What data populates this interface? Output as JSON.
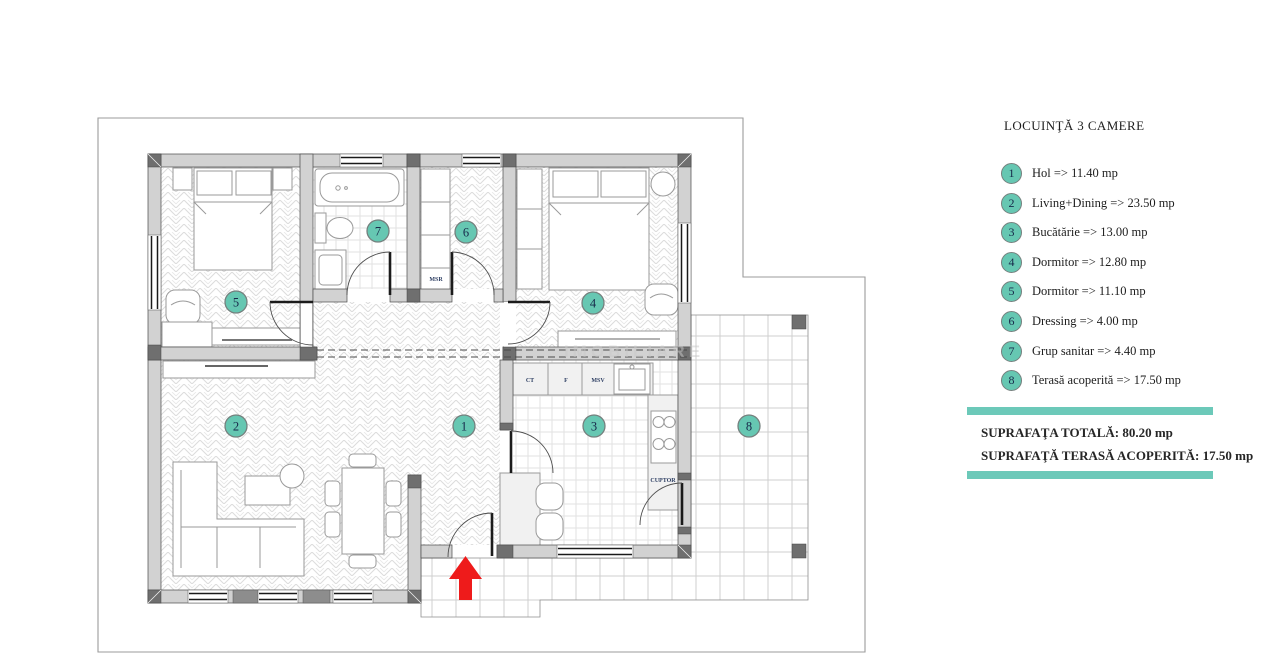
{
  "legend": {
    "title": "LOCUINŢĂ 3 CAMERE",
    "items": [
      {
        "num": "1",
        "label": "Hol => 11.40 mp"
      },
      {
        "num": "2",
        "label": "Living+Dining => 23.50 mp"
      },
      {
        "num": "3",
        "label": "Bucătărie => 13.00 mp"
      },
      {
        "num": "4",
        "label": "Dormitor => 12.80 mp"
      },
      {
        "num": "5",
        "label": "Dormitor => 11.10 mp"
      },
      {
        "num": "6",
        "label": "Dressing => 4.00 mp"
      },
      {
        "num": "7",
        "label": "Grup sanitar => 4.40 mp"
      },
      {
        "num": "8",
        "label": "Terasă acoperită => 17.50 mp"
      }
    ],
    "totals": {
      "line1": "SUPRAFAŢA TOTALĂ: 80.20 mp",
      "line2": "SUPRAFAŢĂ TERASĂ ACOPERITĂ: 17.50 mp"
    }
  },
  "plan": {
    "room_numbers": [
      "1",
      "2",
      "3",
      "4",
      "5",
      "6",
      "7",
      "8"
    ],
    "labels": {
      "msr": "MSR",
      "ct": "CT",
      "f": "F",
      "msv": "MSV",
      "cuptor": "CUPTOR"
    },
    "watermark": "IMOBILIARE"
  },
  "colors": {
    "teal_badge": "#66C7B2",
    "teal_bar": "#6CC9B9",
    "arrow_red": "#EE1B1B"
  }
}
